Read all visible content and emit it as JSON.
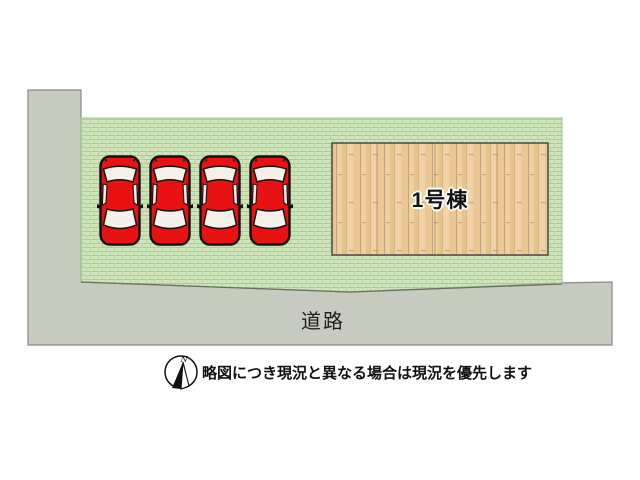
{
  "plan": {
    "building": {
      "label": "1号棟"
    },
    "road": {
      "label": "道路"
    },
    "parking": {
      "count": 4,
      "car_color": "#e81212"
    },
    "colors": {
      "grass_base": "#cde5b8",
      "grass_line": "#a8cf95",
      "road_fill": "#c6cabf",
      "road_border": "#868c82",
      "wood_base": "#ecca96",
      "car_red": "#e81212"
    }
  },
  "footer": {
    "compass_label": "N",
    "disclaimer": "略図につき現況と異なる場合は現況を優先します"
  }
}
